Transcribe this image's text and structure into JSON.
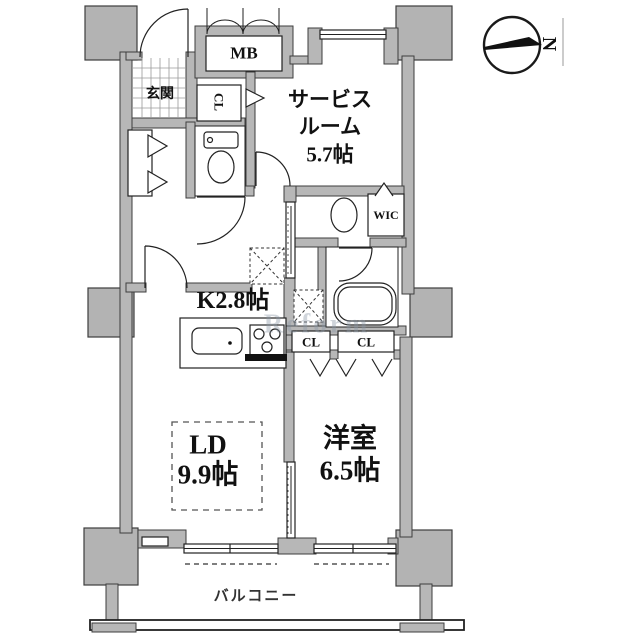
{
  "floorplan": {
    "labels": {
      "meter_box": "MB",
      "entrance": "玄関",
      "hall_closet": "CL",
      "service_room_line1": "サービス",
      "service_room_line2": "ルーム",
      "service_room_area": "5.7帖",
      "walk_in_closet": "WIC",
      "kitchen": "K2.8帖",
      "closet_left": "CL",
      "closet_right": "CL",
      "living_dining": "LD",
      "living_dining_area": "9.9帖",
      "western_room": "洋室",
      "western_room_area": "6.5帖",
      "balcony": "バルコニー",
      "compass_north": "N",
      "watermark": "Reform"
    },
    "colors": {
      "wall_fill": "#b7b7b7",
      "pillar_fill": "#b3b3b3",
      "wall_outline": "#3d3d3d",
      "line": "#222222",
      "text": "#111111"
    }
  }
}
